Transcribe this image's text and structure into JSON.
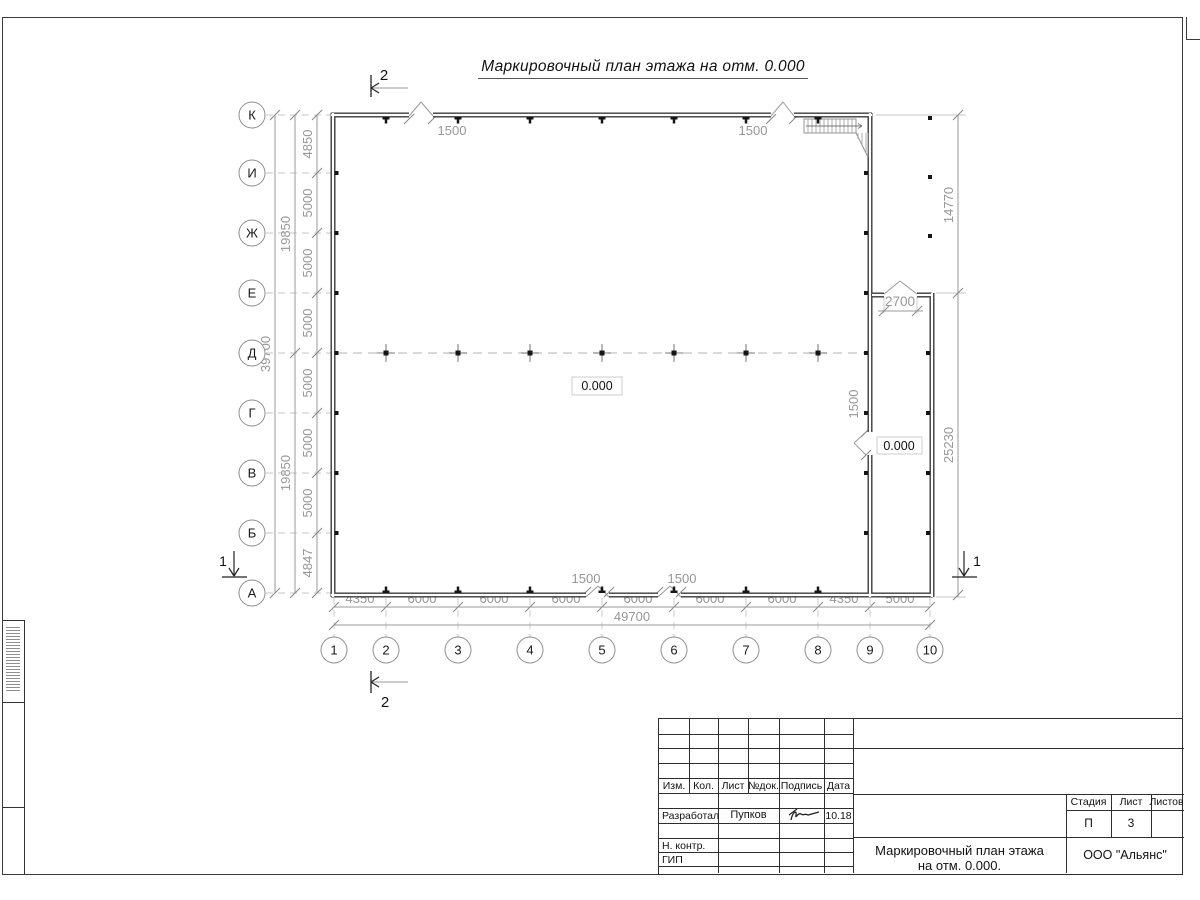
{
  "sheet_title": "Маркировочный план этажа на отм. 0.000",
  "plan": {
    "row_axes": [
      "К",
      "И",
      "Ж",
      "Е",
      "Д",
      "Г",
      "В",
      "Б",
      "А"
    ],
    "col_axes": [
      "1",
      "2",
      "3",
      "4",
      "5",
      "6",
      "7",
      "8",
      "9",
      "10"
    ],
    "row_dims": [
      "4850",
      "5000",
      "5000",
      "5000",
      "5000",
      "5000",
      "5000",
      "4847"
    ],
    "row_span_dims": [
      "19850",
      "19850"
    ],
    "row_total_dim": "39700",
    "col_dims": [
      "4350",
      "6000",
      "6000",
      "6000",
      "6000",
      "6000",
      "6000",
      "4350",
      "5000"
    ],
    "col_total_dim": "49700",
    "right_dims": [
      "14770",
      "25230"
    ],
    "top_gate_dims": [
      "1500",
      "1500"
    ],
    "bottom_gate_dims": [
      "1500",
      "1500"
    ],
    "side_gate_dim": "1500",
    "annex_gate_dim": "2700",
    "elevation_center": "0.000",
    "elevation_annex": "0.000",
    "section_top": "2",
    "section_bottom": "2",
    "section_left": "1",
    "section_right": "1"
  },
  "title_block": {
    "columns": [
      "Изм.",
      "Кол.",
      "Лист",
      "№док.",
      "Подпись",
      "Дата"
    ],
    "row_developed": {
      "role": "Разработал",
      "name": "Пупков",
      "date": "10.18"
    },
    "row_ncontr": "Н. контр.",
    "row_gip": "ГИП",
    "doc_title_line1": "Маркировочный план этажа",
    "doc_title_line2": "на отм. 0.000.",
    "org": "ООО \"Альянс\"",
    "stage_columns": [
      "Стадия",
      "Лист",
      "Листов"
    ],
    "stage": "П",
    "sheet_number": "3"
  }
}
